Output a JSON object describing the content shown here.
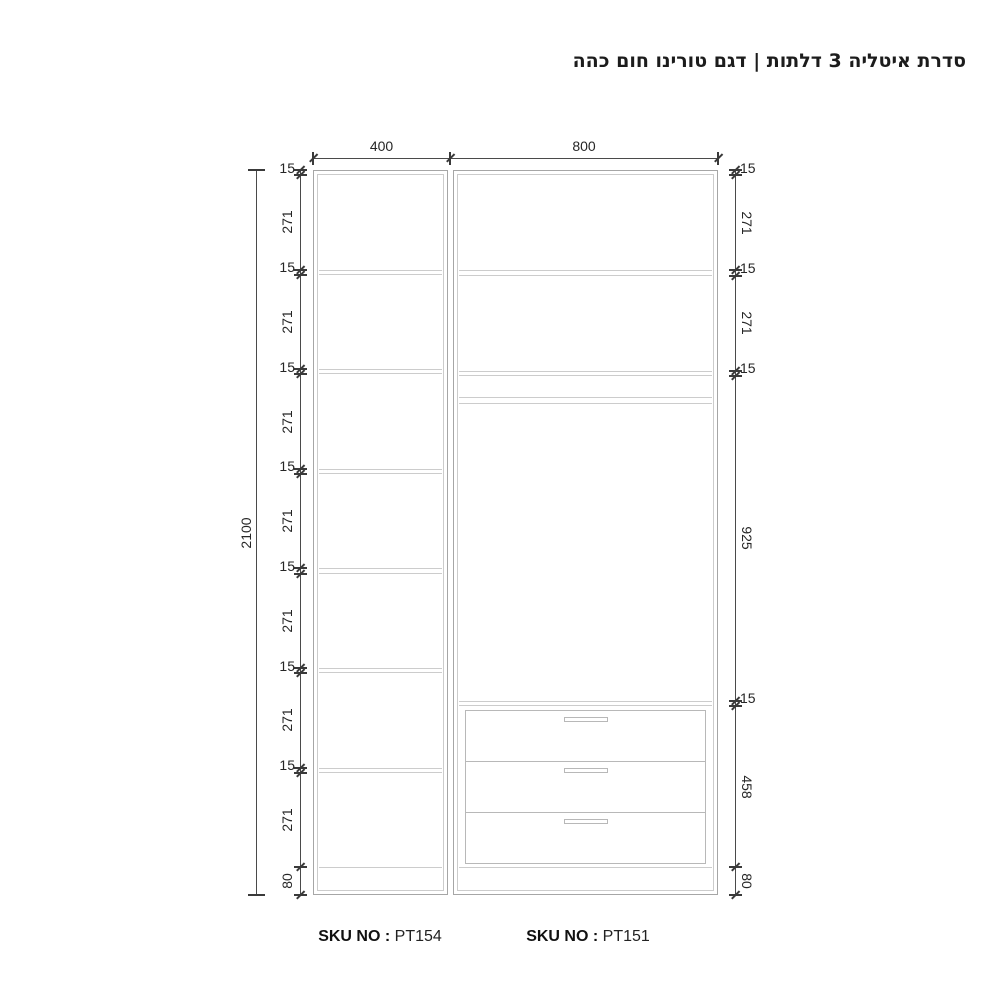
{
  "title": "סדרת איטליה 3 דלתות | דגם טורינו חום כהה",
  "top_dimensions": [
    {
      "value": "400",
      "cabinet": "left"
    },
    {
      "value": "800",
      "cabinet": "right"
    }
  ],
  "overall_height": "2100",
  "left_dimension_chain": [
    "15",
    "271",
    "15",
    "271",
    "15",
    "271",
    "15",
    "271",
    "15",
    "271",
    "15",
    "271",
    "15",
    "271",
    "80"
  ],
  "right_dimension_chain": [
    "15",
    "271",
    "15",
    "271",
    "15",
    "925",
    "15",
    "458",
    "80"
  ],
  "left_cabinet": {
    "shelf_count": 6,
    "compartment_count": 7
  },
  "right_cabinet": {
    "shelf_count": 2,
    "drawer_count": 3,
    "has_hanging_rod": true
  },
  "skus": [
    {
      "label": "SKU NO :",
      "value": "PT154"
    },
    {
      "label": "SKU NO :",
      "value": "PT151"
    }
  ],
  "colors": {
    "cabinet_line": "#a6a6a6",
    "cabinet_detail_line": "#cccccc",
    "drawer_line": "#b8b8b8",
    "dimension_line": "#4a4a4a",
    "tick": "#3a3a3a",
    "text": "#262626",
    "title_text": "#1c1c1c"
  }
}
